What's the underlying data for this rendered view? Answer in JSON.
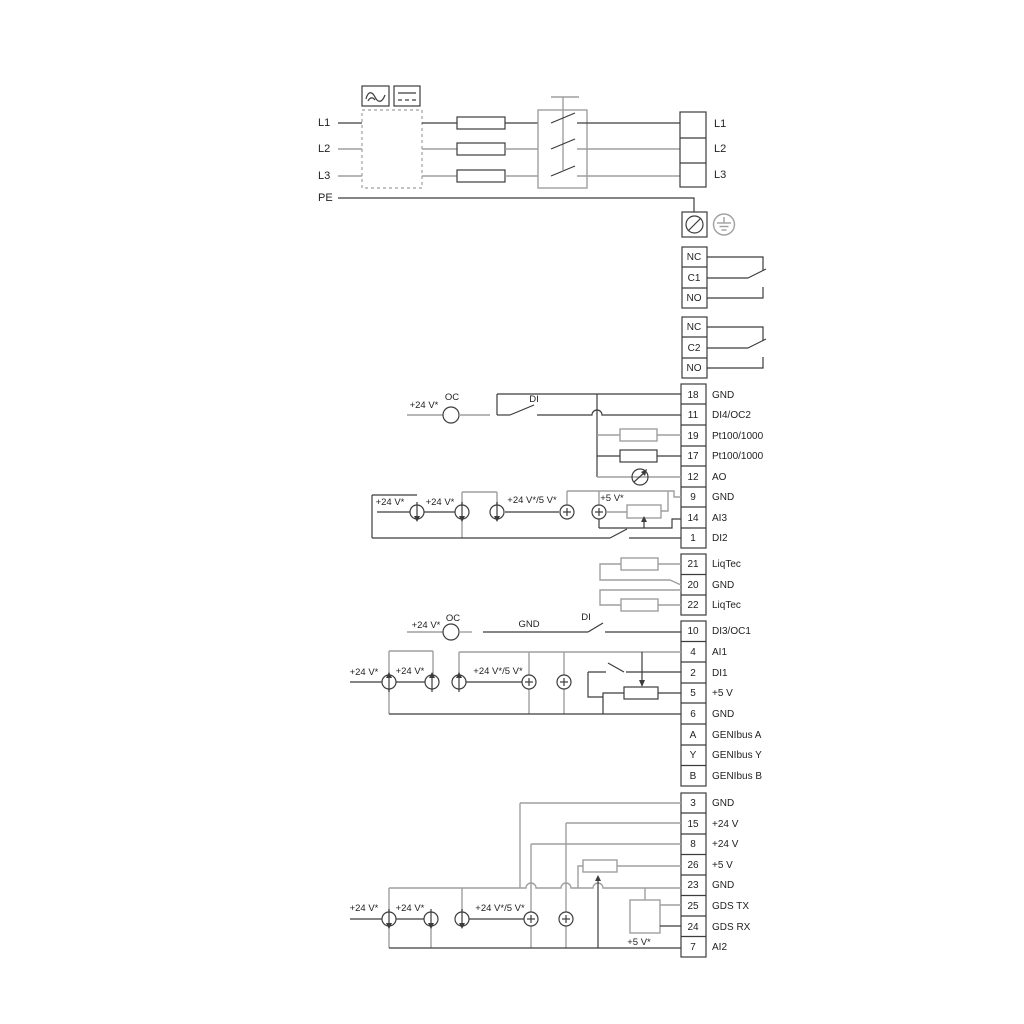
{
  "diagram": {
    "mains": {
      "inputs": [
        "L1",
        "L2",
        "L3",
        "PE"
      ],
      "outputs": [
        "L1",
        "L2",
        "L3"
      ]
    },
    "relay1": [
      "NC",
      "C1",
      "NO"
    ],
    "relay2": [
      "NC",
      "C2",
      "NO"
    ],
    "io_top": [
      {
        "no": "18",
        "label": "GND"
      },
      {
        "no": "11",
        "label": "DI4/OC2"
      },
      {
        "no": "19",
        "label": "Pt100/1000"
      },
      {
        "no": "17",
        "label": "Pt100/1000"
      },
      {
        "no": "12",
        "label": "AO"
      },
      {
        "no": "9",
        "label": "GND"
      },
      {
        "no": "14",
        "label": "AI3"
      },
      {
        "no": "1",
        "label": "DI2"
      }
    ],
    "liqtec": [
      {
        "no": "21",
        "label": "LiqTec"
      },
      {
        "no": "20",
        "label": "GND"
      },
      {
        "no": "22",
        "label": "LiqTec"
      }
    ],
    "io_mid": [
      {
        "no": "10",
        "label": "DI3/OC1"
      },
      {
        "no": "4",
        "label": "AI1"
      },
      {
        "no": "2",
        "label": "DI1"
      },
      {
        "no": "5",
        "label": "+5 V"
      },
      {
        "no": "6",
        "label": "GND"
      },
      {
        "no": "A",
        "label": "GENIbus A"
      },
      {
        "no": "Y",
        "label": "GENIbus Y"
      },
      {
        "no": "B",
        "label": "GENIbus B"
      }
    ],
    "io_bottom": [
      {
        "no": "3",
        "label": "GND"
      },
      {
        "no": "15",
        "label": "+24 V"
      },
      {
        "no": "8",
        "label": "+24 V"
      },
      {
        "no": "26",
        "label": "+5 V"
      },
      {
        "no": "23",
        "label": "GND"
      },
      {
        "no": "25",
        "label": "GDS TX"
      },
      {
        "no": "24",
        "label": "GDS RX"
      },
      {
        "no": "7",
        "label": "AI2"
      }
    ],
    "ann": {
      "a_supply": "+24 V*",
      "a_oc": "OC",
      "a_di": "DI",
      "b1": "+24 V*",
      "b2": "+24 V*",
      "b3": "+24 V*/5 V*",
      "b4": "+5 V*",
      "c_supply": "+24 V*",
      "c_oc": "OC",
      "c_gnd": "GND",
      "c_di": "DI",
      "c1": "+24 V*",
      "c2": "+24 V*",
      "c3": "+24 V*/5 V*",
      "d1": "+24 V*",
      "d2": "+24 V*",
      "d3": "+24 V*/5 V*",
      "d4": "+5 V*"
    },
    "colors": {
      "wire_dark": "#3c3c3c",
      "wire_grey": "#9f9f9f",
      "text": "#1f1f1f",
      "background": "#ffffff"
    }
  }
}
